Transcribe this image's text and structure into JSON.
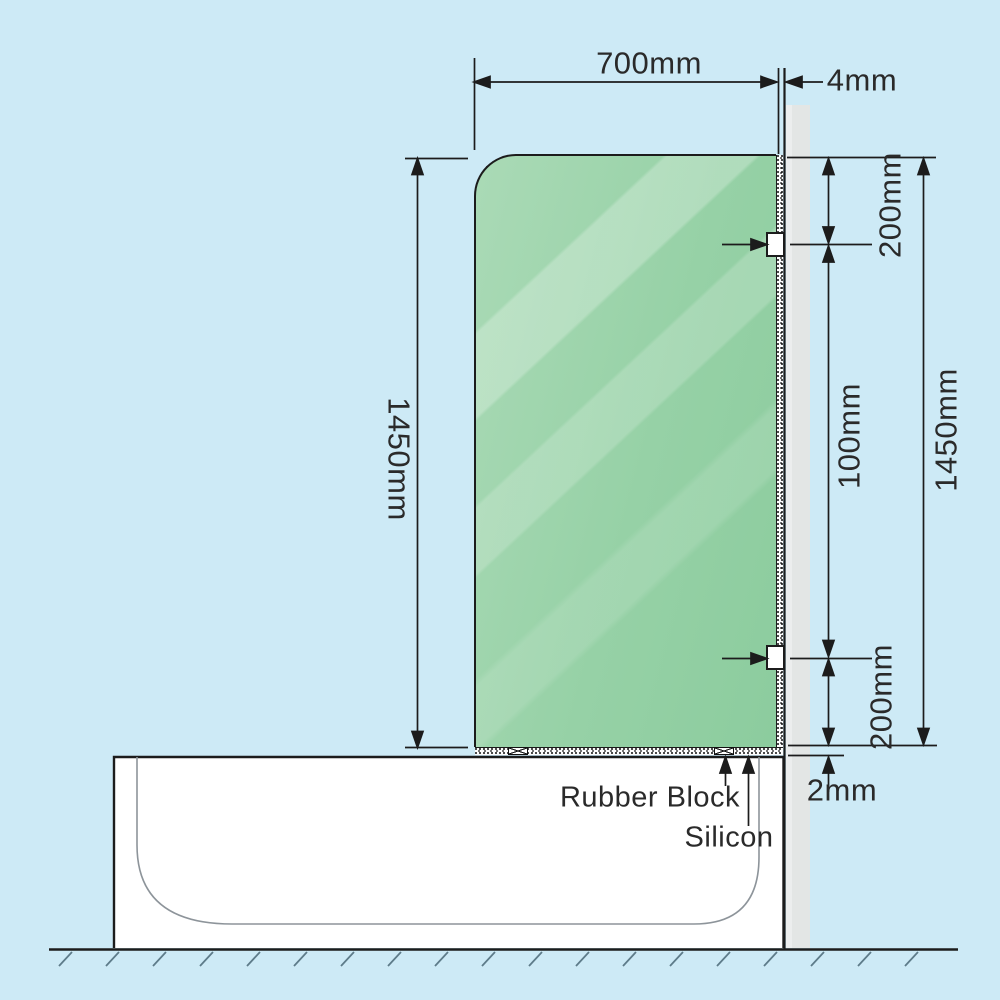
{
  "diagram": {
    "title": "bath shower screen installation diagram",
    "dims": {
      "panel_width": "700mm",
      "wall_gap": "4mm",
      "panel_height_left": "1450mm",
      "bracket_top_offset": "200mm",
      "bracket_spacing": "100mm",
      "panel_height_right": "1450mm",
      "bracket_bottom_offset": "200mm",
      "tub_gap": "2mm"
    },
    "labels": {
      "rubber_block": "Rubber Block",
      "silicon": "Silicon"
    },
    "colors": {
      "background": "#cdeaf6",
      "glass_green": "#9ad2aa",
      "wall_gray": "#e3e6e5",
      "tub_white": "#ffffff",
      "line": "#1c1c1c"
    }
  }
}
